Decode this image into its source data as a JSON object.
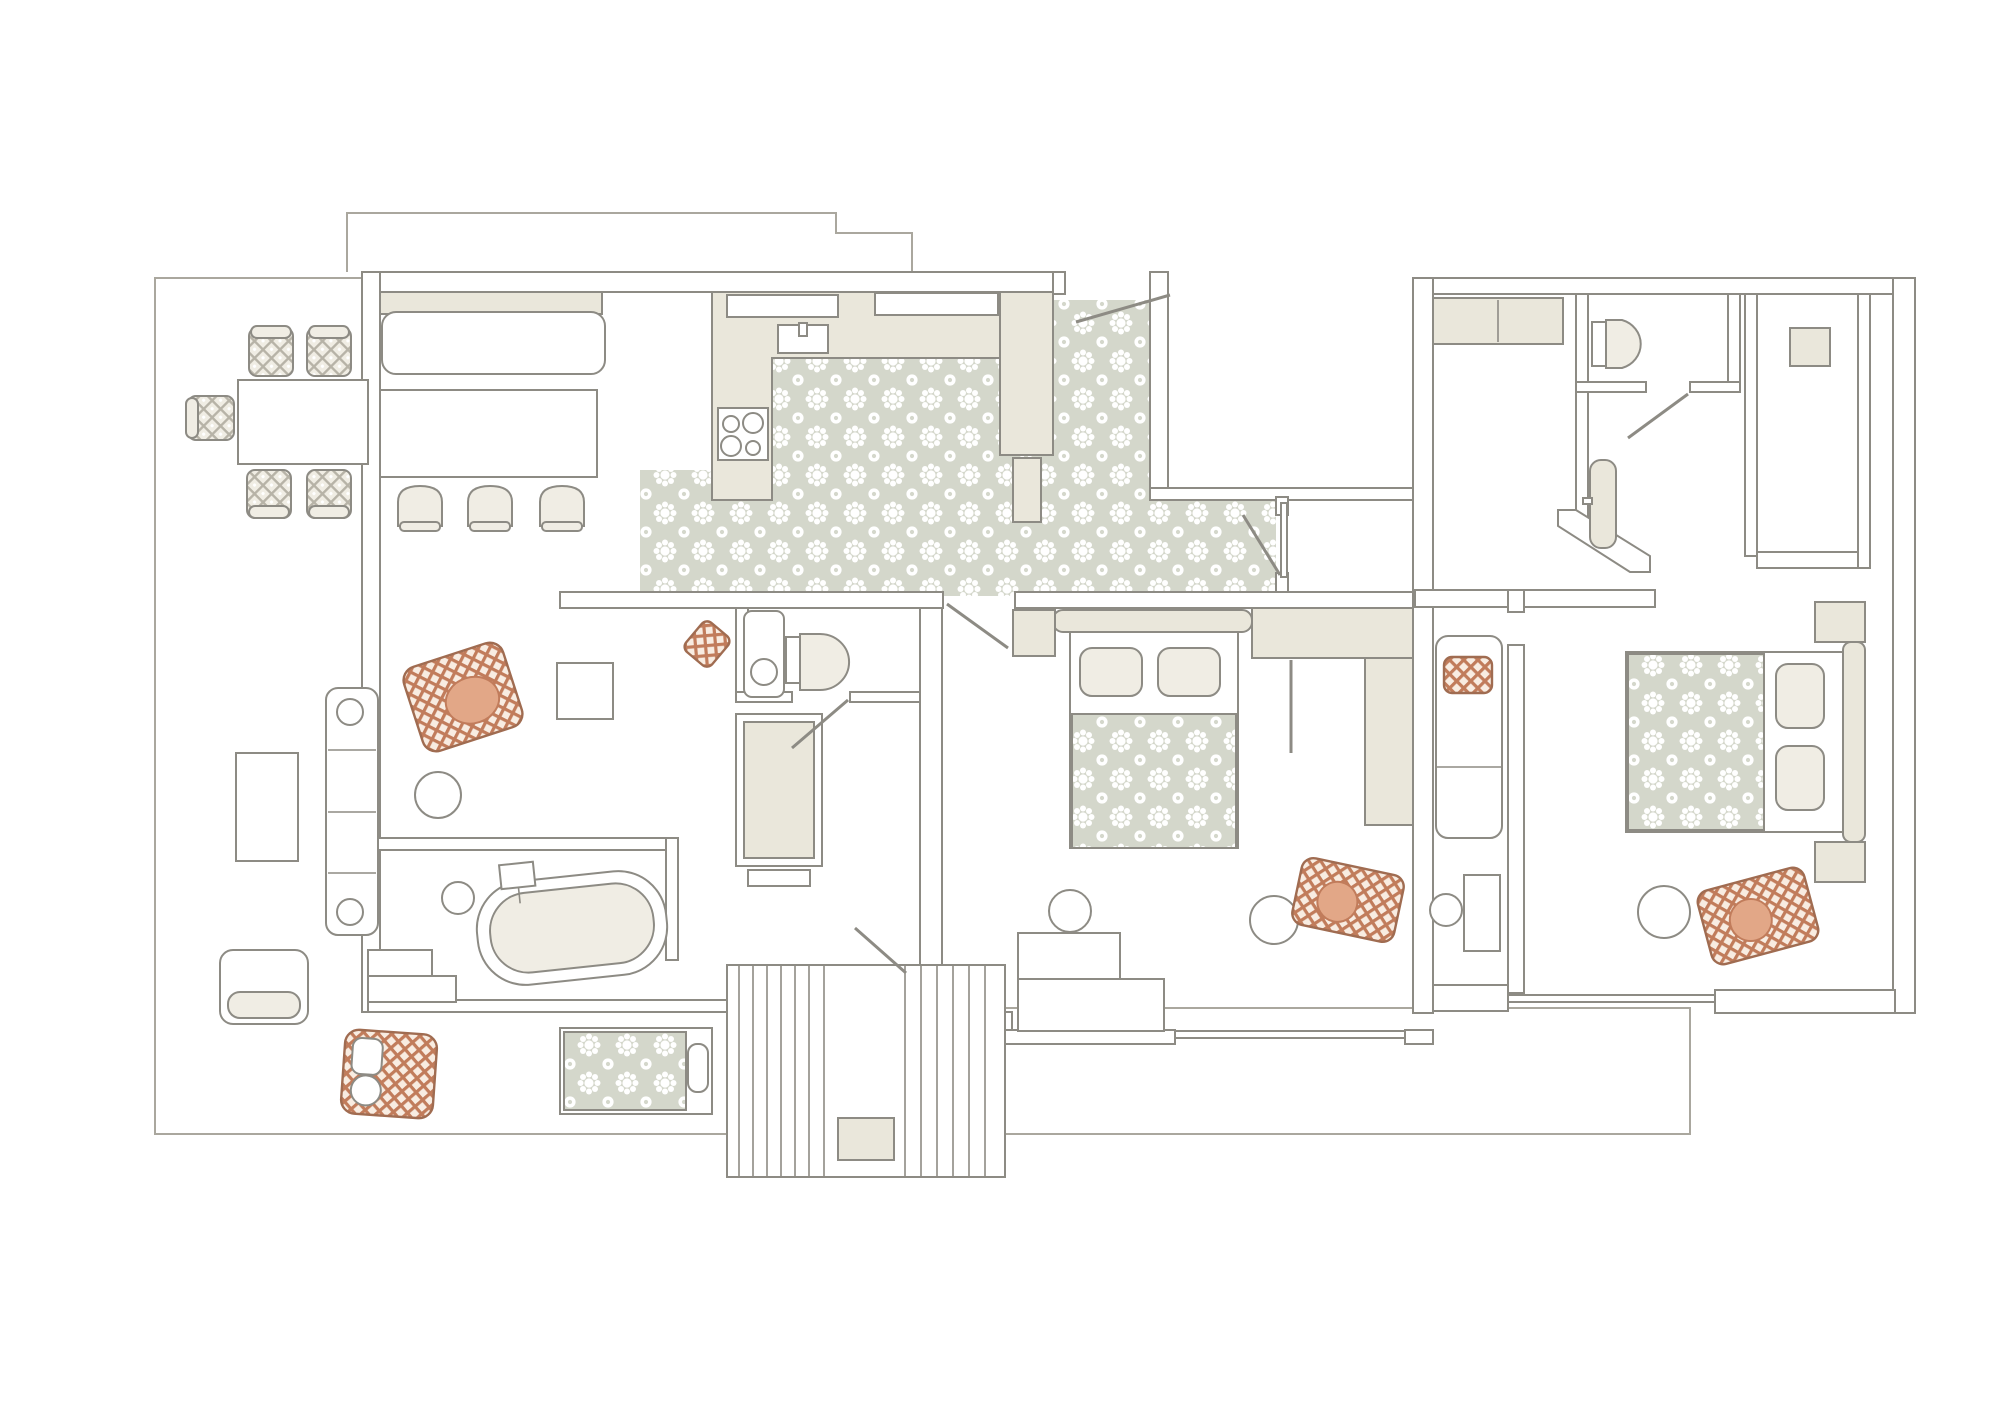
{
  "meta": {
    "title": "apartment-floor-plan",
    "view": "top-down architectural plan, no text labels",
    "canvas": {
      "width": 1999,
      "height": 1414
    }
  },
  "colors": {
    "paper": "#ffffff",
    "wall_stroke": "#8d8b84",
    "wall_fill": "#ffffff",
    "furniture_white": "#ffffff",
    "furniture_beige": "#eae7db",
    "cushion_bg": "#f0ede4",
    "line_light": "#aaa79e",
    "tile_bg": "#d4d7cb",
    "tile_motif": "#ffffff",
    "deck_bg": "#fdfcf9",
    "deck_line": "#e6e0d6",
    "rug_bg": "#f8ece1",
    "rug_line": "#c17c5b",
    "rug_border": "#a06c51",
    "rug_accent": "#e2a787"
  },
  "inventory": {
    "terrace": {
      "floor": "wood-deck-stripes",
      "items": [
        "dining-table",
        "dining-chair x5 (patterned cushions)",
        "outdoor-sofa",
        "side-table",
        "low-table",
        "lounger",
        "orange-area-rug",
        "small-orange-mat",
        "round-pouf"
      ]
    },
    "dining-bar": {
      "items": [
        "window-bench",
        "long-table",
        "bar-stool x3"
      ]
    },
    "kitchen": {
      "floor": "floral-cement-tile",
      "items": [
        "l-shaped-counter",
        "sink",
        "cooktop-4-burners",
        "tall-cabinet",
        "pantry-strip"
      ]
    },
    "entry-hall": {
      "floor": "floral-cement-tile",
      "items": [
        "entry-sliding-door",
        "hall-door"
      ]
    },
    "bathroom-main": {
      "items": [
        "freestanding-bathtub",
        "faucet",
        "round-stool",
        "corner-steps"
      ]
    },
    "wc": {
      "items": [
        "toilet",
        "washbasin-cabinet"
      ]
    },
    "corridor": {
      "items": [
        "wardrobe-with-shelf",
        "deck-door"
      ]
    },
    "bedroom-middle": {
      "items": [
        "double-bed",
        "pillow x2",
        "patterned-blanket",
        "nightstand",
        "closet-top",
        "closet-side",
        "folding-screen",
        "desk-steps",
        "desk-chair",
        "round-pouf",
        "orange-rug-with-seat"
      ]
    },
    "bedroom-right": {
      "items": [
        "double-bed",
        "pillow x2",
        "patterned-blanket",
        "headboard",
        "nightstand x2",
        "round-pouf",
        "orange-rug-with-seat",
        "sliding-glass-door"
      ]
    },
    "right-wing-hall": {
      "items": [
        "doormat",
        "hall-cabinet",
        "desk",
        "desk-chair",
        "wardrobe-strip",
        "diagonal-wall"
      ]
    },
    "bathroom-small": {
      "items": [
        "toilet",
        "pedestal-sink",
        "wall-cabinet-square"
      ]
    },
    "outdoor-lower-deck": {
      "items": [
        "rattan-daybed (2 pillows)",
        "tiled-daybed (1 pillow)",
        "exterior-stairs-2-flights",
        "doormat"
      ]
    },
    "courtyard": {
      "items": []
    },
    "counts": {
      "rooms": 9,
      "beds": 2,
      "bathrooms": 3,
      "stair_flights": 2,
      "stools": 3,
      "dining_chairs": 5,
      "orange_rugs": 6
    }
  }
}
